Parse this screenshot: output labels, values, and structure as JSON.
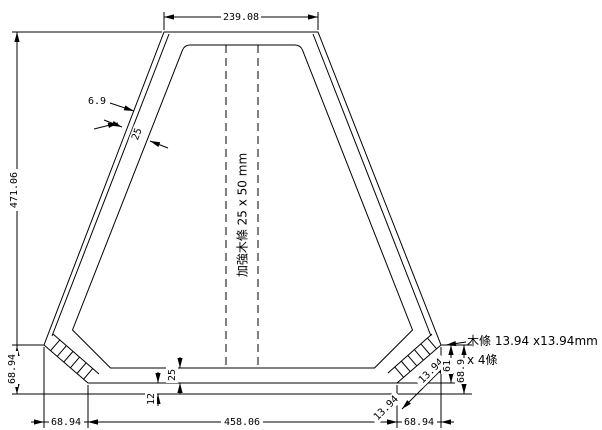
{
  "notes": {
    "center_vertical": "加強木條 25 x 50 mm",
    "corner_line1": "木條 13.94 x13.94mm",
    "corner_line2": "x 4條"
  },
  "dims": {
    "top_width": "239.08",
    "overall_height": "471.06",
    "left_corner_height": "68.94",
    "bottom_left": "68.94",
    "bottom_center": "458.06",
    "bottom_right": "68.94",
    "outer_skin_thickness": "6.9",
    "side_wall_thickness": "25",
    "bottom_wall_thickness": "25",
    "bottom_skin_thickness": "12",
    "corner_strip_diag_upper": "13.94",
    "corner_strip_diag_lower": "13.94",
    "right_corner_inner_height": "61",
    "right_corner_outer_height": "68.9"
  },
  "colors": {
    "line": "#000000",
    "background": "#ffffff"
  }
}
